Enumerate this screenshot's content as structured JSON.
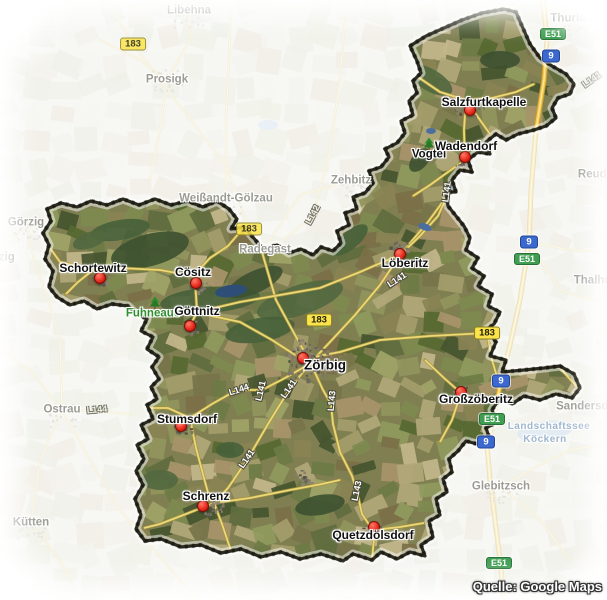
{
  "map": {
    "credit": "Quelle: Google Maps",
    "towns": [
      {
        "name": "Salzfurtkapelle",
        "x": 484,
        "y": 102,
        "marker": {
          "x": 470,
          "y": 110
        }
      },
      {
        "name": "Wadendorf",
        "x": 466,
        "y": 146,
        "marker": {
          "x": 465,
          "y": 157
        }
      },
      {
        "name": "Löberitz",
        "x": 405,
        "y": 263,
        "marker": {
          "x": 400,
          "y": 254
        }
      },
      {
        "name": "Cösitz",
        "x": 193,
        "y": 272,
        "marker": {
          "x": 196,
          "y": 283
        }
      },
      {
        "name": "Schortewitz",
        "x": 93,
        "y": 268,
        "marker": {
          "x": 100,
          "y": 278
        }
      },
      {
        "name": "Göttnitz",
        "x": 197,
        "y": 311,
        "marker": {
          "x": 190,
          "y": 326
        }
      },
      {
        "name": "Zörbig",
        "x": 325,
        "y": 365,
        "big": true,
        "marker": {
          "x": 303,
          "y": 358
        }
      },
      {
        "name": "Großzöberitz",
        "x": 476,
        "y": 399,
        "marker": {
          "x": 461,
          "y": 392
        }
      },
      {
        "name": "Stumsdorf",
        "x": 187,
        "y": 419,
        "marker": {
          "x": 181,
          "y": 426
        }
      },
      {
        "name": "Schrenz",
        "x": 206,
        "y": 496,
        "marker": {
          "x": 203,
          "y": 506
        }
      },
      {
        "name": "Quetzdölsdorf",
        "x": 373,
        "y": 535,
        "marker": {
          "x": 374,
          "y": 527
        }
      }
    ],
    "places": [
      {
        "name": "Vogtei",
        "x": 429,
        "y": 155
      }
    ],
    "nature_labels": [
      {
        "name": "Fuhneaue",
        "x": 153,
        "y": 314
      }
    ],
    "tree_icons": [
      {
        "x": 155,
        "y": 303
      },
      {
        "x": 429,
        "y": 144
      }
    ],
    "faded_towns": [
      {
        "name": "Libehna",
        "x": 189,
        "y": 11
      },
      {
        "name": "Prosigk",
        "x": 167,
        "y": 80
      },
      {
        "name": "Weißandt-Gölzau",
        "x": 226,
        "y": 199
      },
      {
        "name": "Zehbitz",
        "x": 351,
        "y": 181
      },
      {
        "name": "Radegast",
        "x": 265,
        "y": 250
      },
      {
        "name": "Görzig",
        "x": 26,
        "y": 223
      },
      {
        "name": "Glauzig",
        "x": -6,
        "y": 258
      },
      {
        "name": "Ostrau",
        "x": 62,
        "y": 410
      },
      {
        "name": "Kütten",
        "x": 31,
        "y": 523
      },
      {
        "name": "Glebitzsch",
        "x": 501,
        "y": 487
      },
      {
        "name": "Thurland",
        "x": 575,
        "y": 19
      },
      {
        "name": "Thalheim",
        "x": 599,
        "y": 281
      },
      {
        "name": "Sandersdorf",
        "x": 590,
        "y": 407
      },
      {
        "name": "Reuden",
        "x": 599,
        "y": 175
      }
    ],
    "lake_labels": [
      {
        "name": "Landschaftssee",
        "x": 549,
        "y": 427
      },
      {
        "name": "Köckern",
        "x": 545,
        "y": 440
      }
    ],
    "road_badges": [
      {
        "label": "183",
        "kind": "b-road",
        "x": 133,
        "y": 44,
        "dim": true
      },
      {
        "label": "183",
        "kind": "b-road",
        "x": 249,
        "y": 229,
        "dim": true
      },
      {
        "label": "183",
        "kind": "b-road",
        "x": 319,
        "y": 320
      },
      {
        "label": "183",
        "kind": "b-road",
        "x": 487,
        "y": 333
      },
      {
        "label": "9",
        "kind": "autobahn",
        "x": 551,
        "y": 56
      },
      {
        "label": "9",
        "kind": "autobahn",
        "x": 529,
        "y": 242
      },
      {
        "label": "9",
        "kind": "autobahn",
        "x": 501,
        "y": 381
      },
      {
        "label": "9",
        "kind": "autobahn",
        "x": 486,
        "y": 442
      },
      {
        "label": "E51",
        "kind": "e-road",
        "x": 553,
        "y": 34
      },
      {
        "label": "E51",
        "kind": "e-road",
        "x": 527,
        "y": 259
      },
      {
        "label": "E51",
        "kind": "e-road",
        "x": 492,
        "y": 419
      },
      {
        "label": "E51",
        "kind": "e-road",
        "x": 499,
        "y": 563
      }
    ],
    "road_labels": [
      {
        "text": "L141",
        "x": 447,
        "y": 192,
        "angle": -83
      },
      {
        "text": "L141",
        "x": 397,
        "y": 280,
        "angle": -33
      },
      {
        "text": "L141",
        "x": 289,
        "y": 389,
        "angle": -55
      },
      {
        "text": "L141",
        "x": 247,
        "y": 459,
        "angle": -55
      },
      {
        "text": "L141",
        "x": 261,
        "y": 391,
        "angle": -77
      },
      {
        "text": "L143",
        "x": 332,
        "y": 401,
        "angle": -85
      },
      {
        "text": "L143",
        "x": 357,
        "y": 491,
        "angle": -78
      },
      {
        "text": "L144",
        "x": 239,
        "y": 390,
        "angle": -18
      },
      {
        "text": "L142",
        "x": 313,
        "y": 215,
        "angle": -62,
        "dim": true
      },
      {
        "text": "L144",
        "x": 97,
        "y": 410,
        "angle": -5,
        "dim": true
      },
      {
        "text": "L141",
        "x": 592,
        "y": 80,
        "angle": -35,
        "dim": true
      }
    ],
    "colors": {
      "region_border": "#2a2a1e",
      "road_yellow": "#ead978",
      "autobahn_orange": "#f2c94e",
      "badge_yellow": "#fbe44b",
      "badge_blue": "#3b69cf",
      "badge_green": "#3f9e52",
      "marker_red": "#e3261a",
      "nature_green": "#2f8f2f",
      "faded_label_gray": "#9c9c94",
      "lake_label_blue": "#9fb6cc"
    }
  }
}
